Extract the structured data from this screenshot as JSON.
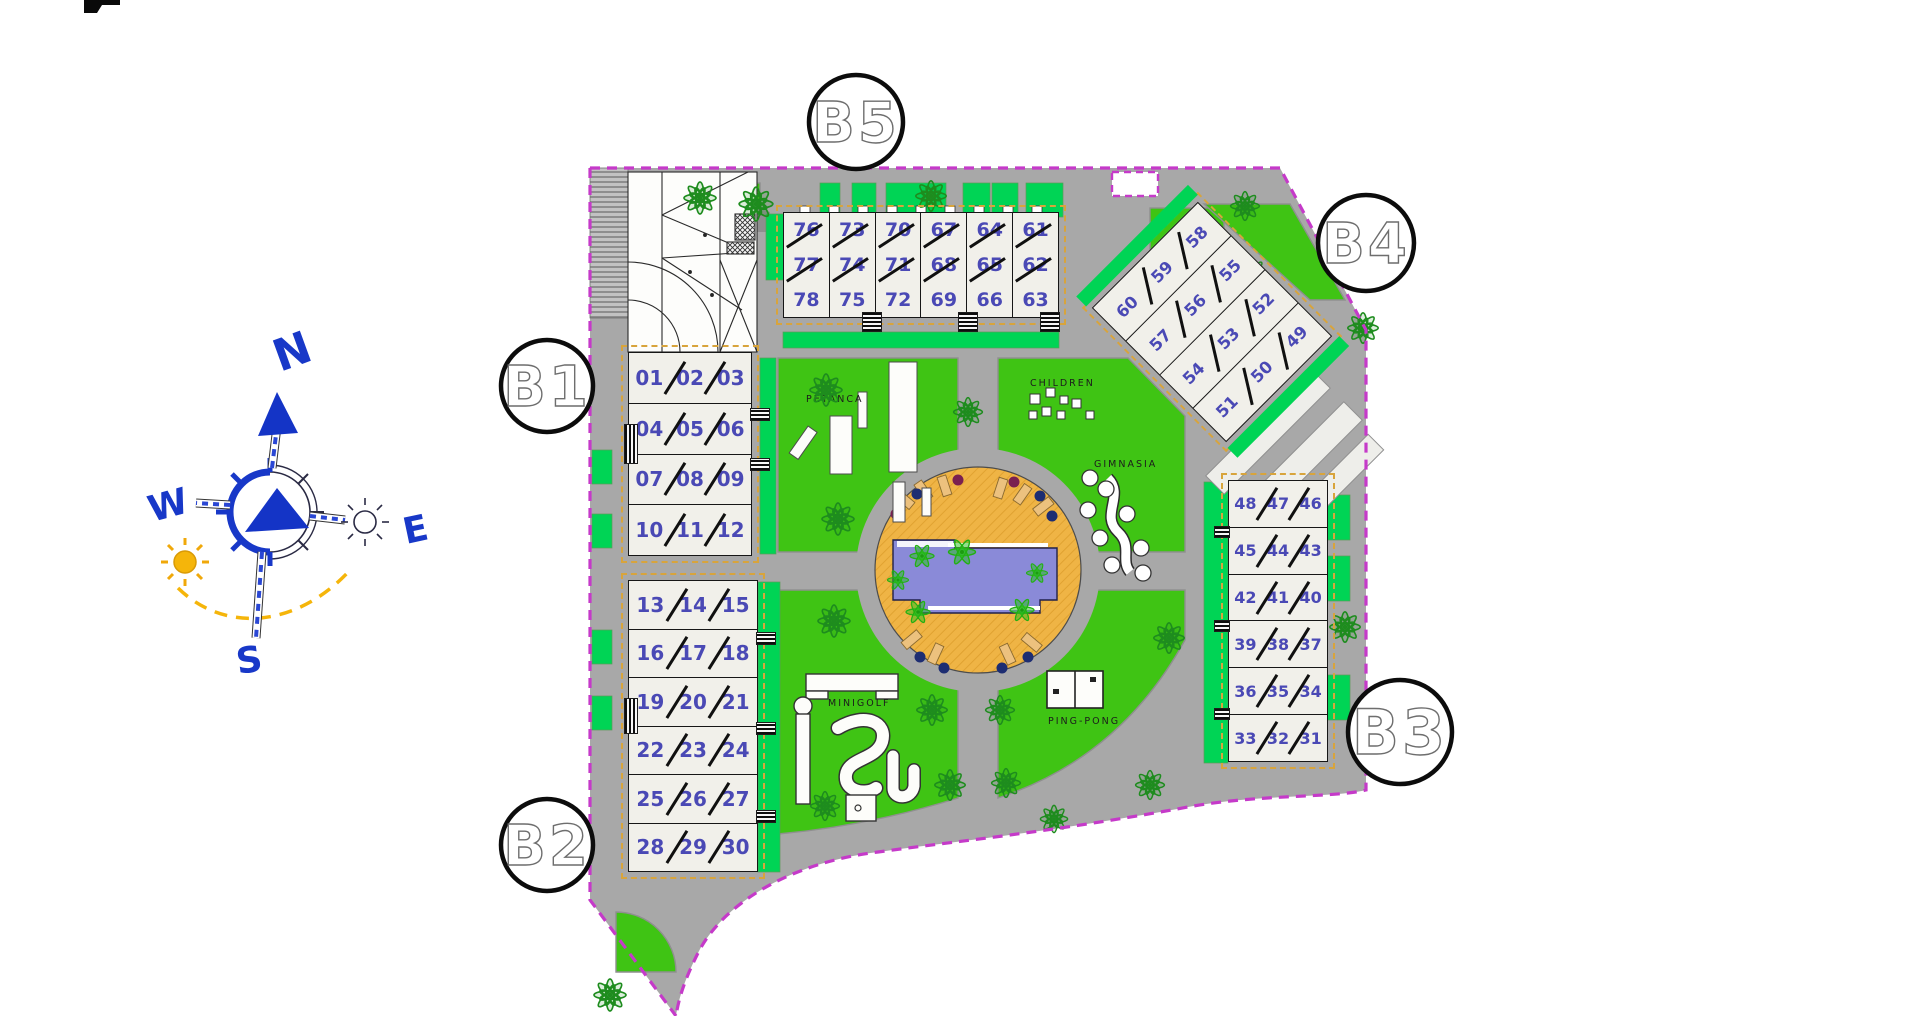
{
  "block_markers": {
    "b1": "B1",
    "b2": "B2",
    "b3": "B3",
    "b4": "B4",
    "b5": "B5"
  },
  "compass": {
    "n": "N",
    "s": "S",
    "e": "E",
    "w": "W"
  },
  "plan_labels": {
    "petanca": "PETANCA",
    "children": "CHILDREN",
    "gimnasia": "GIMNASIA",
    "minigolf": "MINIGOLF",
    "ping_pong": "PING-PONG"
  },
  "buildings": {
    "b5": {
      "columns": [
        [
          "76",
          "77",
          "78"
        ],
        [
          "73",
          "74",
          "75"
        ],
        [
          "70",
          "71",
          "72"
        ],
        [
          "67",
          "68",
          "69"
        ],
        [
          "64",
          "65",
          "66"
        ],
        [
          "61",
          "62",
          "63"
        ]
      ]
    },
    "b4": {
      "rows": [
        [
          "60",
          "59",
          "58"
        ],
        [
          "57",
          "56",
          "55"
        ],
        [
          "54",
          "53",
          "52"
        ],
        [
          "51",
          "50",
          "49"
        ]
      ]
    },
    "b1": {
      "rows": [
        [
          "01",
          "02",
          "03"
        ],
        [
          "04",
          "05",
          "06"
        ],
        [
          "07",
          "08",
          "09"
        ],
        [
          "10",
          "11",
          "12"
        ]
      ]
    },
    "b2": {
      "rows": [
        [
          "13",
          "14",
          "15"
        ],
        [
          "16",
          "17",
          "18"
        ],
        [
          "19",
          "20",
          "21"
        ],
        [
          "22",
          "23",
          "24"
        ],
        [
          "25",
          "26",
          "27"
        ],
        [
          "28",
          "29",
          "30"
        ]
      ]
    },
    "b3": {
      "rows": [
        [
          "48",
          "47",
          "46"
        ],
        [
          "45",
          "44",
          "43"
        ],
        [
          "42",
          "41",
          "40"
        ],
        [
          "39",
          "38",
          "37"
        ],
        [
          "36",
          "35",
          "34"
        ],
        [
          "33",
          "32",
          "31"
        ]
      ]
    }
  },
  "colors": {
    "boundary": "#c53ac9",
    "road": "#a8a8a8",
    "lawn": "#3fc414",
    "emerald": "#00d455",
    "pool_deck": "#efb445",
    "pool_water": "#8a8ad8",
    "compass_blue": "#1838c8",
    "sun_yellow": "#f5b50a",
    "unit_number": "#4a49b5"
  }
}
